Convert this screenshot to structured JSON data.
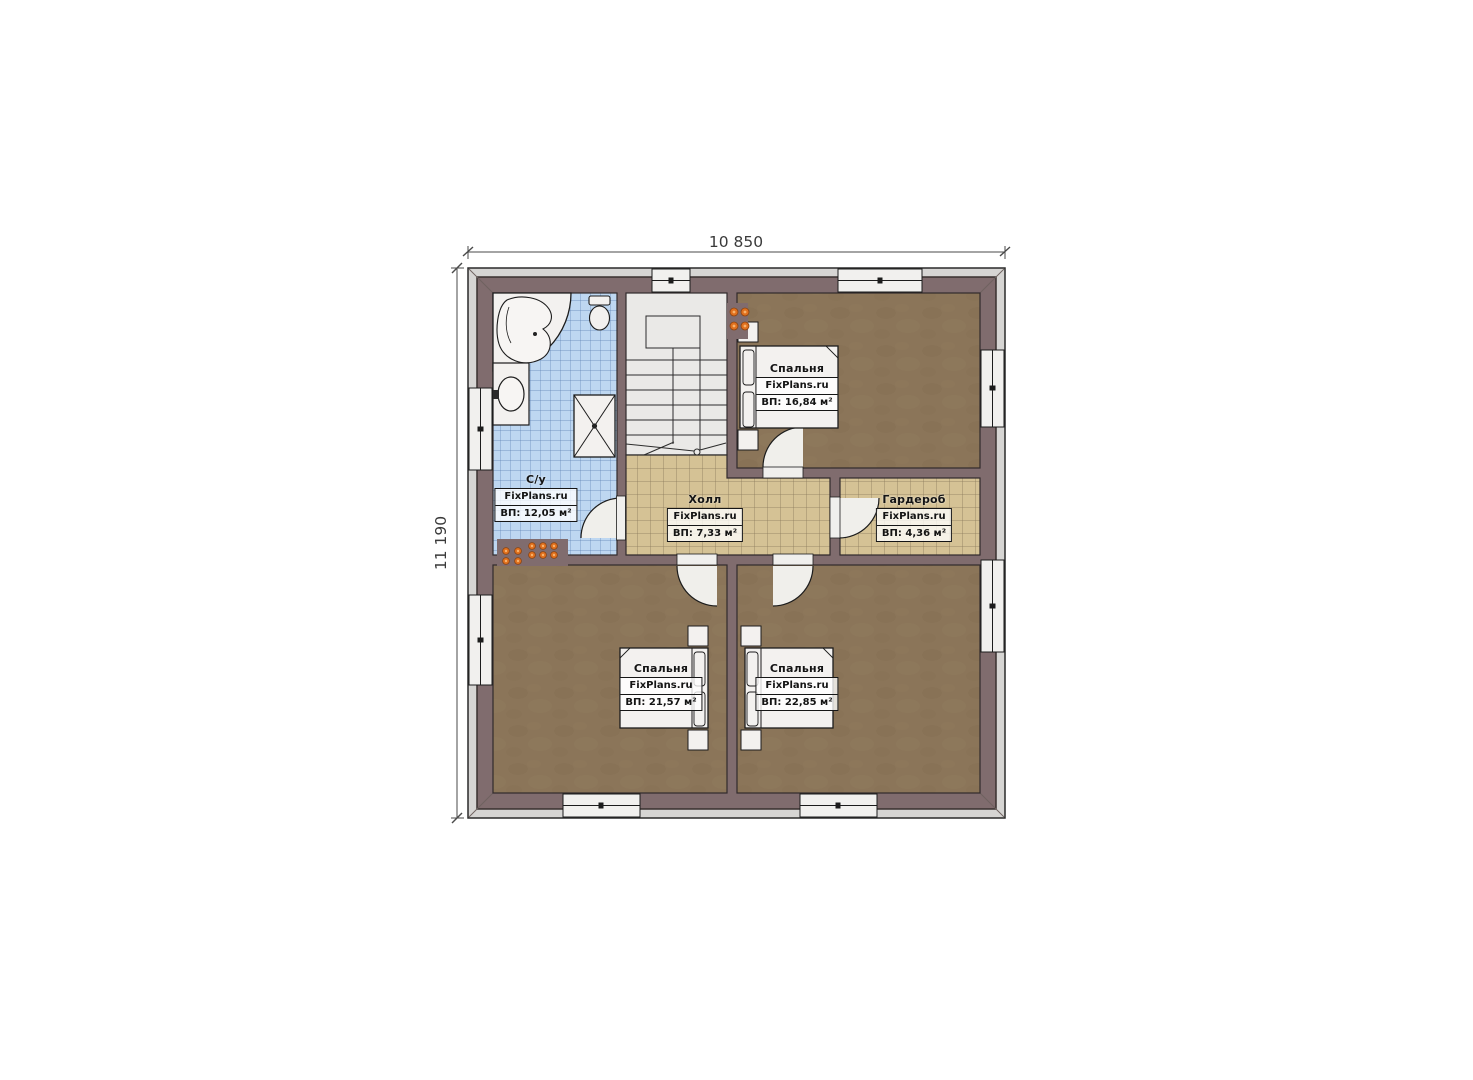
{
  "watermark": "FixPlans.ru",
  "dimensions": {
    "width": "10 850",
    "height": "11 190"
  },
  "rooms": [
    {
      "id": "bathroom",
      "name": "С/у",
      "area": "ВП: 12,05 м²"
    },
    {
      "id": "hall",
      "name": "Холл",
      "area": "ВП: 7,33 м²"
    },
    {
      "id": "wardrobe",
      "name": "Гардероб",
      "area": "ВП: 4,36 м²"
    },
    {
      "id": "bedroom_top",
      "name": "Спальня",
      "area": "ВП: 16,84 м²"
    },
    {
      "id": "bedroom_left",
      "name": "Спальня",
      "area": "ВП: 21,57 м²"
    },
    {
      "id": "bedroom_right",
      "name": "Спальня",
      "area": "ВП: 22,85 м²"
    }
  ],
  "colors": {
    "wall": "#806c6e",
    "floor_wood": "#8b7559",
    "tile_beige": "#d5c295",
    "tile_blue": "#bed7f1",
    "radiator": "#e0701e"
  }
}
